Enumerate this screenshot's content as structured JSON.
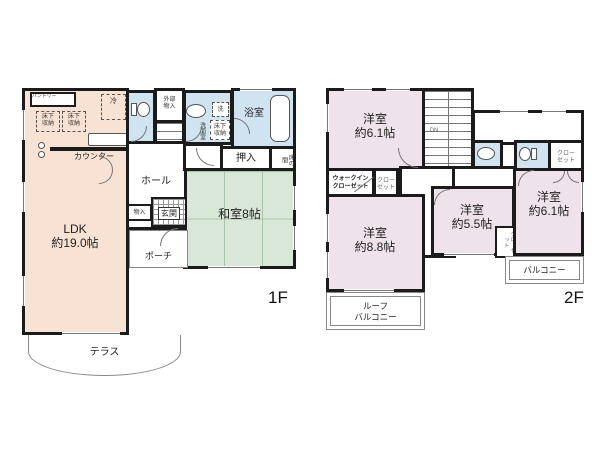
{
  "colors": {
    "wall": "#1b1b1b",
    "ldk": "#f7e2d3",
    "tatami": "#d9e7d8",
    "wet": "#cfe3f1",
    "bedroom": "#efe3eb"
  },
  "icons": [
    "toilet-icon",
    "sink-icon",
    "bathtub-icon",
    "stove-burners-icon"
  ],
  "f1": {
    "floor_label": "1F",
    "ldk": {
      "name": "LDK",
      "size": "約19.0帖"
    },
    "washitsu": "和室8帖",
    "hall": "ホール",
    "genkan": "玄関",
    "porch": "ポーチ",
    "terrace": "テラス",
    "bathroom": "浴室",
    "washroom": "洗面室",
    "washer": "洗",
    "oshiire": "押入",
    "tokonoma": "床の間",
    "fridge": "冷",
    "counter": "カウンター",
    "pantry": "パントリー",
    "underfloor": {
      "line1": "床下",
      "line2": "収納"
    },
    "ext_storage": {
      "line1": "外部",
      "line2": "物入"
    },
    "storage": "物入",
    "stairs": "UP"
  },
  "f2": {
    "floor_label": "2F",
    "rooms": {
      "nw": {
        "name": "洋室",
        "size": "約6.1帖"
      },
      "sw": {
        "name": "洋室",
        "size": "約8.8帖"
      },
      "s": {
        "name": "洋室",
        "size": "約5.5帖"
      },
      "se": {
        "name": "洋室",
        "size": "約6.1帖"
      }
    },
    "stairs": "DN",
    "wic": {
      "line1": "ウォークイン",
      "line2": "クローゼット"
    },
    "closet": {
      "line1": "クロー",
      "line2": "ゼット"
    },
    "closet_vertical": "クローゼット",
    "balcony": "バルコニー",
    "roof_balcony": {
      "line1": "ルーフ",
      "line2": "バルコニー"
    }
  }
}
